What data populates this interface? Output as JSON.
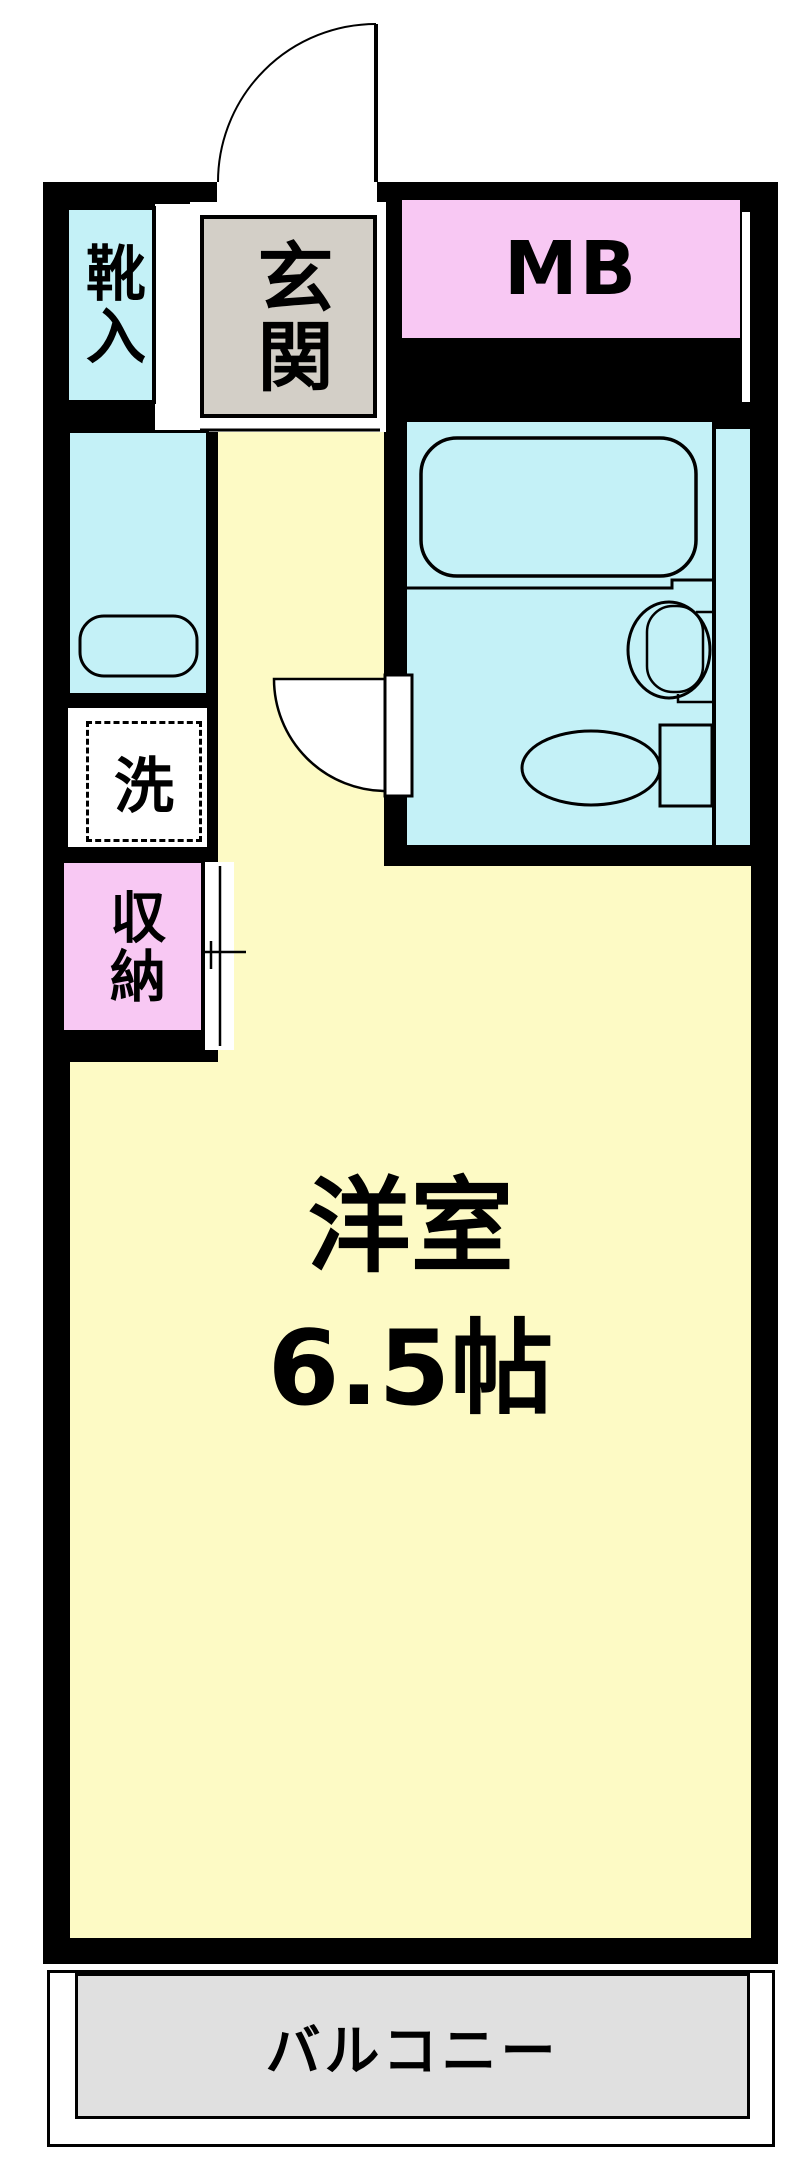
{
  "plan": {
    "rooms": {
      "entrance": {
        "label": "玄関"
      },
      "shoe_cabinet": {
        "label": "靴入"
      },
      "meter_box": {
        "label": "MB"
      },
      "laundry": {
        "label": "洗"
      },
      "storage": {
        "label": "収納"
      },
      "main_room": {
        "label": "洋室",
        "size": "6.5帖"
      },
      "balcony": {
        "label": "バルコニー"
      }
    },
    "colors": {
      "wall": "#000000",
      "room_floor": "#FDFAC5",
      "wet_area": "#C4F1F7",
      "utility_box": "#F8C8F3",
      "entrance_floor": "#D3CFC7",
      "balcony_floor": "#E0E0E0"
    }
  }
}
